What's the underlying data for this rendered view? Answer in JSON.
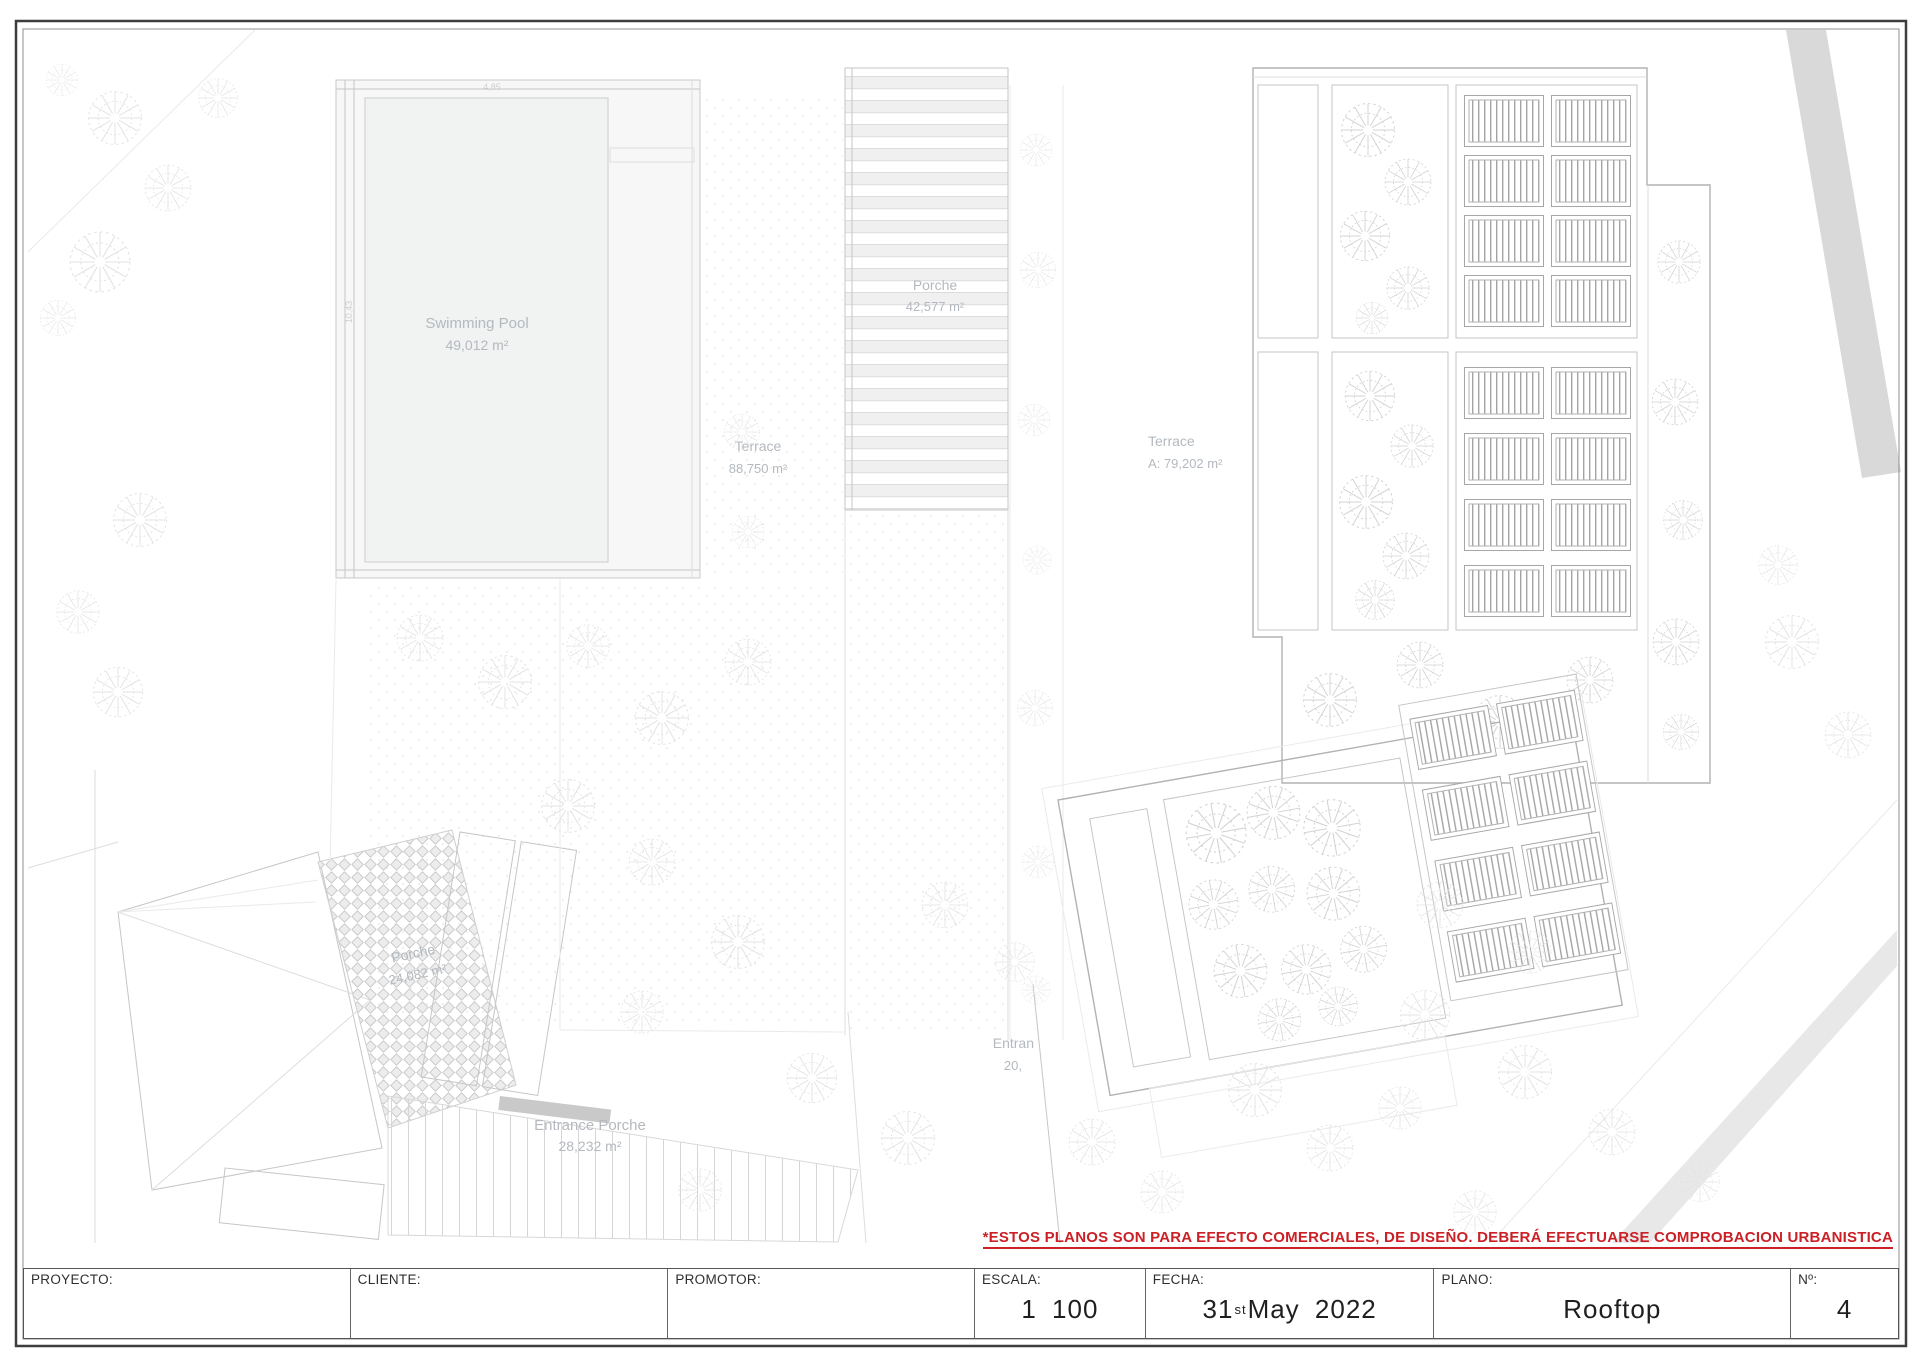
{
  "notes": {
    "disclaimer": "*ESTOS PLANOS SON PARA EFECTO COMERCIALES, DE DISEÑO. DEBERÁ EFECTUARSE COMPROBACION URBANISTICA",
    "disclaimer_color": "#cb2026"
  },
  "title_block": {
    "cells": [
      {
        "label": "PROYECTO:",
        "value": ""
      },
      {
        "label": "CLIENTE:",
        "value": ""
      },
      {
        "label": "PROMOTOR:",
        "value": ""
      },
      {
        "label": "ESCALA:",
        "value": "1 100"
      },
      {
        "label": "FECHA:",
        "date_day": "31",
        "date_ordinal": "st",
        "date_rest": " May 2022"
      },
      {
        "label": "PLANO:",
        "value": "Rooftop"
      },
      {
        "label": "Nº:",
        "value": "4"
      }
    ]
  },
  "plan": {
    "areas": {
      "swimming_pool": {
        "name": "Swimming Pool",
        "area": "49,012 m²"
      },
      "porche_top": {
        "name": "Porche",
        "area": "42,577 m²"
      },
      "terrace_center": {
        "name": "Terrace",
        "area": "88,750 m²"
      },
      "terrace_right": {
        "name": "Terrace",
        "area": "A: 79,202 m²"
      },
      "porche_lower": {
        "name": "Porche",
        "area": "24,082 m²"
      },
      "entrance_porche": {
        "name": "Entrance Porche",
        "area": "28,232 m²"
      },
      "entrance_partial": {
        "name": "Entran",
        "area": "20,"
      }
    },
    "dims": {
      "pool_width": "4,85",
      "pool_height": "10,43"
    }
  }
}
